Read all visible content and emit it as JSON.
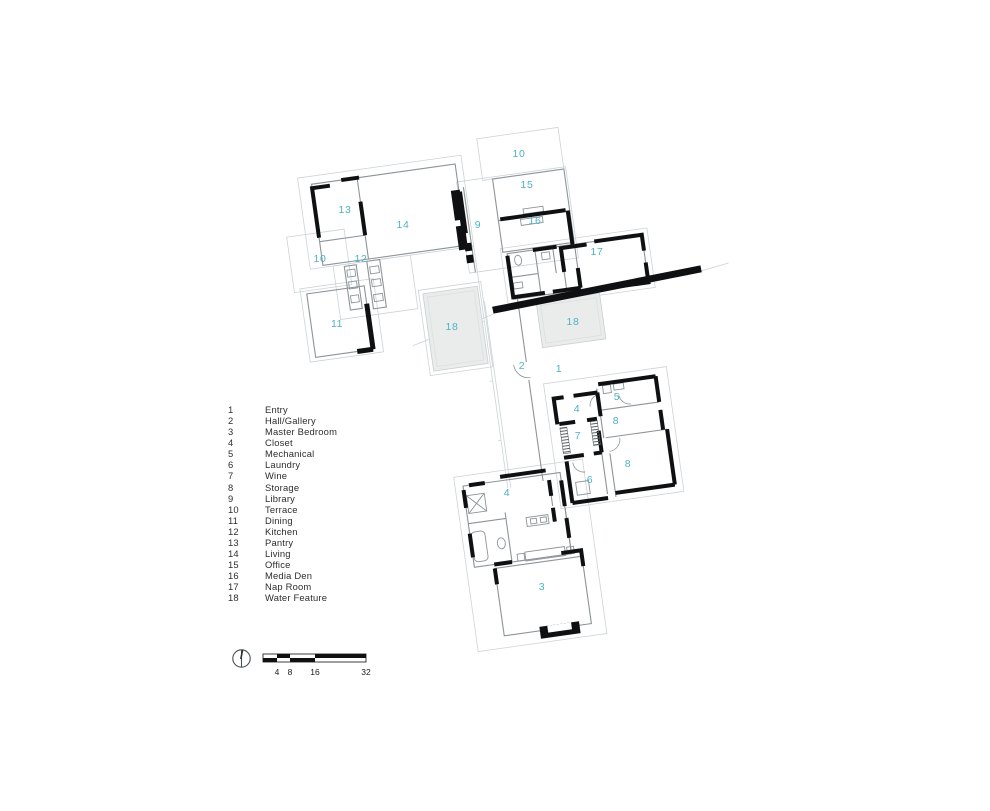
{
  "document": {
    "kind": "architectural floor plan",
    "background": "#ffffff"
  },
  "plan": {
    "colors": {
      "label": "#4db2c6",
      "wall": "#0e1012",
      "thin": "#8d9498",
      "site": "#ccd3d6",
      "water": "#eaecec"
    },
    "room_labels": [
      {
        "n": "13",
        "x": 345,
        "y": 210
      },
      {
        "n": "14",
        "x": 403,
        "y": 225
      },
      {
        "n": "12",
        "x": 361,
        "y": 259
      },
      {
        "n": "10",
        "x": 320,
        "y": 259
      },
      {
        "n": "11",
        "x": 337,
        "y": 324
      },
      {
        "n": "18",
        "x": 452,
        "y": 327
      },
      {
        "n": "9",
        "x": 478,
        "y": 225
      },
      {
        "n": "10",
        "x": 519,
        "y": 154
      },
      {
        "n": "15",
        "x": 527,
        "y": 185
      },
      {
        "n": "16",
        "x": 535,
        "y": 221
      },
      {
        "n": "17",
        "x": 597,
        "y": 252
      },
      {
        "n": "18",
        "x": 573,
        "y": 322
      },
      {
        "n": "2",
        "x": 522,
        "y": 366
      },
      {
        "n": "1",
        "x": 559,
        "y": 369
      },
      {
        "n": "4",
        "x": 577,
        "y": 409
      },
      {
        "n": "5",
        "x": 617,
        "y": 397
      },
      {
        "n": "8",
        "x": 616,
        "y": 421
      },
      {
        "n": "7",
        "x": 578,
        "y": 436
      },
      {
        "n": "8",
        "x": 628,
        "y": 464
      },
      {
        "n": "6",
        "x": 590,
        "y": 480
      },
      {
        "n": "4",
        "x": 507,
        "y": 493
      },
      {
        "n": "3",
        "x": 542,
        "y": 587
      }
    ]
  },
  "legend": {
    "items": [
      {
        "num": "1",
        "label": "Entry"
      },
      {
        "num": "2",
        "label": "Hall/Gallery"
      },
      {
        "num": "3",
        "label": "Master Bedroom"
      },
      {
        "num": "4",
        "label": "Closet"
      },
      {
        "num": "5",
        "label": "Mechanical"
      },
      {
        "num": "6",
        "label": "Laundry"
      },
      {
        "num": "7",
        "label": "Wine"
      },
      {
        "num": "8",
        "label": "Storage"
      },
      {
        "num": "9",
        "label": "Library"
      },
      {
        "num": "10",
        "label": "Terrace"
      },
      {
        "num": "11",
        "label": "Dining"
      },
      {
        "num": "12",
        "label": "Kitchen"
      },
      {
        "num": "13",
        "label": "Pantry"
      },
      {
        "num": "14",
        "label": "Living"
      },
      {
        "num": "15",
        "label": "Office"
      },
      {
        "num": "16",
        "label": "Media Den"
      },
      {
        "num": "17",
        "label": "Nap Room"
      },
      {
        "num": "18",
        "label": "Water Feature"
      }
    ]
  },
  "scale": {
    "labels": [
      {
        "text": "4",
        "x": 277
      },
      {
        "text": "8",
        "x": 290
      },
      {
        "text": "16",
        "x": 315
      },
      {
        "text": "32",
        "x": 366
      }
    ]
  },
  "icons": [
    {
      "name": "north-arrow-icon"
    }
  ]
}
